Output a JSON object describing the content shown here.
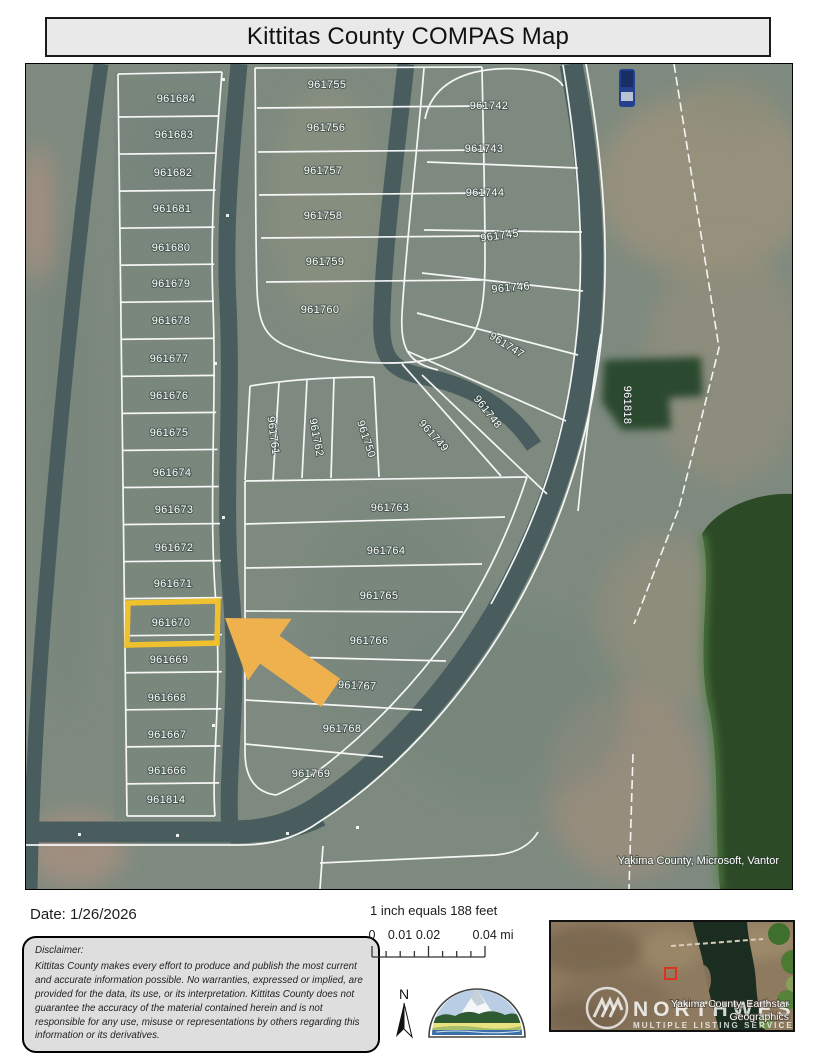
{
  "title": "Kittitas County COMPAS Map",
  "map": {
    "highlighted_parcel": "961670",
    "attribution": "Yakima County, Microsoft, Vantor",
    "colors": {
      "highlight": "#EFC12F",
      "arrow": "#EEB14D",
      "road": "#4A5D5E",
      "terrain": "#7E8A7F",
      "water": "#2C4A26",
      "parcel_line": "#FFFFFF"
    },
    "parcels": [
      {
        "id": "961684",
        "x": 150,
        "y": 38,
        "r": 0
      },
      {
        "id": "961683",
        "x": 148,
        "y": 74,
        "r": 0
      },
      {
        "id": "961682",
        "x": 147,
        "y": 112,
        "r": 0
      },
      {
        "id": "961681",
        "x": 146,
        "y": 148,
        "r": 0
      },
      {
        "id": "961680",
        "x": 145,
        "y": 187,
        "r": 0
      },
      {
        "id": "961679",
        "x": 145,
        "y": 223,
        "r": 0
      },
      {
        "id": "961678",
        "x": 145,
        "y": 260,
        "r": 0
      },
      {
        "id": "961677",
        "x": 143,
        "y": 298,
        "r": 0
      },
      {
        "id": "961676",
        "x": 143,
        "y": 335,
        "r": 0
      },
      {
        "id": "961675",
        "x": 143,
        "y": 372,
        "r": 0
      },
      {
        "id": "961674",
        "x": 146,
        "y": 412,
        "r": 0
      },
      {
        "id": "961673",
        "x": 148,
        "y": 449,
        "r": 0
      },
      {
        "id": "961672",
        "x": 148,
        "y": 487,
        "r": 0
      },
      {
        "id": "961671",
        "x": 147,
        "y": 523,
        "r": 0
      },
      {
        "id": "961670",
        "x": 145,
        "y": 562,
        "r": 0
      },
      {
        "id": "961669",
        "x": 143,
        "y": 599,
        "r": 0
      },
      {
        "id": "961668",
        "x": 141,
        "y": 637,
        "r": 0
      },
      {
        "id": "961667",
        "x": 141,
        "y": 674,
        "r": 0
      },
      {
        "id": "961666",
        "x": 141,
        "y": 710,
        "r": 0
      },
      {
        "id": "961814",
        "x": 140,
        "y": 739,
        "r": 0
      },
      {
        "id": "961755",
        "x": 301,
        "y": 24,
        "r": 0
      },
      {
        "id": "961756",
        "x": 300,
        "y": 67,
        "r": 0
      },
      {
        "id": "961757",
        "x": 297,
        "y": 110,
        "r": 0
      },
      {
        "id": "961758",
        "x": 297,
        "y": 155,
        "r": 0
      },
      {
        "id": "961759",
        "x": 299,
        "y": 201,
        "r": 0
      },
      {
        "id": "961760",
        "x": 294,
        "y": 249,
        "r": 0
      },
      {
        "id": "961742",
        "x": 463,
        "y": 45,
        "r": 0
      },
      {
        "id": "961743",
        "x": 458,
        "y": 88,
        "r": 0
      },
      {
        "id": "961744",
        "x": 459,
        "y": 132,
        "r": 0
      },
      {
        "id": "961745",
        "x": 474,
        "y": 175,
        "r": -8
      },
      {
        "id": "961746",
        "x": 485,
        "y": 227,
        "r": -5
      },
      {
        "id": "961747",
        "x": 479,
        "y": 284,
        "r": 32
      },
      {
        "id": "961748",
        "x": 459,
        "y": 350,
        "r": 52
      },
      {
        "id": "961761",
        "x": 244,
        "y": 372,
        "r": 82
      },
      {
        "id": "961762",
        "x": 287,
        "y": 374,
        "r": 79
      },
      {
        "id": "961750",
        "x": 337,
        "y": 376,
        "r": 72
      },
      {
        "id": "961749",
        "x": 405,
        "y": 374,
        "r": 48
      },
      {
        "id": "961763",
        "x": 364,
        "y": 447,
        "r": 0
      },
      {
        "id": "961764",
        "x": 360,
        "y": 490,
        "r": 0
      },
      {
        "id": "961765",
        "x": 353,
        "y": 535,
        "r": 0
      },
      {
        "id": "961766",
        "x": 343,
        "y": 580,
        "r": 0
      },
      {
        "id": "961767",
        "x": 331,
        "y": 625,
        "r": 3
      },
      {
        "id": "961768",
        "x": 316,
        "y": 668,
        "r": 0
      },
      {
        "id": "961769",
        "x": 285,
        "y": 713,
        "r": 0
      },
      {
        "id": "961818",
        "x": 598,
        "y": 341,
        "r": 90
      }
    ]
  },
  "footer": {
    "date_label": "Date: 1/26/2026",
    "disclaimer_title": "Disclaimer:",
    "disclaimer_body": "Kittitas County makes every effort to produce and publish the most current and accurate information possible. No warranties, expressed or implied, are provided for the data, its use, or its interpretation. Kittitas County does not guarantee the accuracy of the material contained herein and is not responsible for any use, misuse or representations by others regarding this information or its derivatives.",
    "scale_text": "1 inch equals 188 feet",
    "scale_ticks": [
      "0",
      "0.01",
      "0.02",
      "0.04 mi"
    ],
    "north_label": "N"
  },
  "inset": {
    "attribution_line1": "Yakima County, Earthstar",
    "attribution_line2": "Geographics",
    "watermark_line1": "NORTHWEST",
    "watermark_line2": "MULTIPLE LISTING SERVICE."
  }
}
